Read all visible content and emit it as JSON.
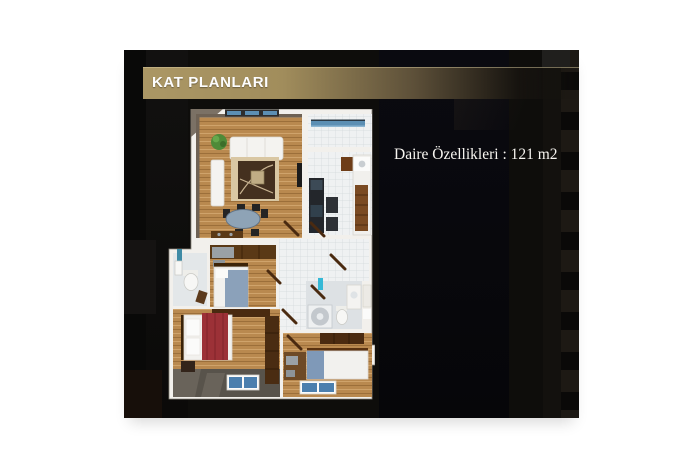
{
  "panel": {
    "header": {
      "title": "KAT PLANLARI"
    },
    "info_text": "Daire Özellikleri : 121 m2",
    "colors": {
      "page_bg": "#ffffff",
      "panel_bg": "#0e0d0b",
      "header_gold": "#ab9765",
      "text_white": "#fdfdfd"
    }
  },
  "floor_plan": {
    "area_text": "121 m2",
    "colors": {
      "wall": "#f2f0ec",
      "wall_shadow": "#8b867c",
      "inner_wall_dark": "#6e6255",
      "wood_floor": "#b9894f",
      "tile_floor": "#eff1f2",
      "rug_dark": "#44301f",
      "rug_beige": "#d9c7a3",
      "bed_red": "#9c3137",
      "bed_blue": "#8ba1ba",
      "mat_blue": "#4b7fae",
      "window_blue": "#5c8fb4",
      "glass_cyan": "#35b8d6",
      "plant_green": "#4e8a38",
      "furniture_wood_dark": "#4a2a10",
      "appliance_dark": "#23262b",
      "terrace_gray": "#58534b"
    }
  }
}
